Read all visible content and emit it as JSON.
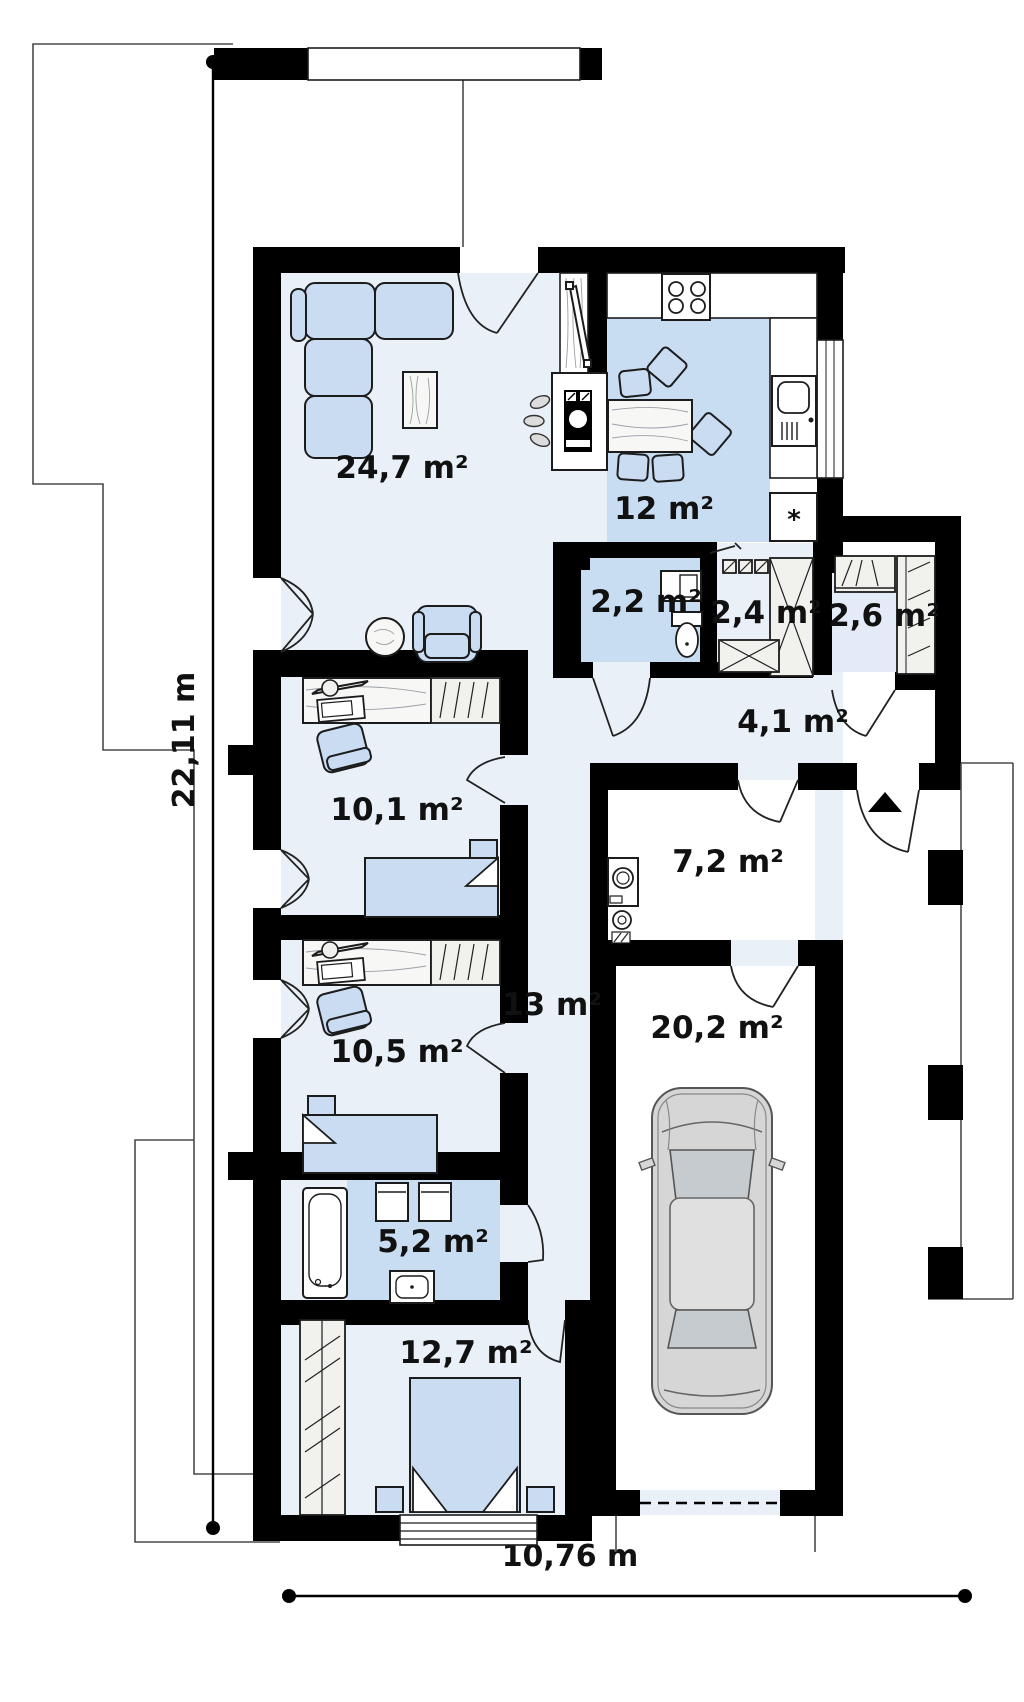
{
  "plan": {
    "type": "single-storey house floor plan with garage",
    "dimensions": {
      "height_label": "22,11 m",
      "width_label": "10,76 m"
    },
    "kitchen_symbols": {
      "fridge_symbol": "*"
    },
    "colors": {
      "wall": "#000000",
      "floor_light": "#eaf0f8",
      "floor_blue": "#c9ddf2",
      "furniture_blue": "#c9dcf2",
      "closet_fill": "#f1f1ee",
      "car_body": "#d6d6d6",
      "label_text": "#111111"
    }
  },
  "rooms": [
    {
      "id": "living-room",
      "area_label": "24,7 m²",
      "x": 402,
      "y": 478
    },
    {
      "id": "kitchen",
      "area_label": "12 m²",
      "x": 664,
      "y": 519
    },
    {
      "id": "wc",
      "area_label": "2,2 m²",
      "x": 646,
      "y": 612
    },
    {
      "id": "storage",
      "area_label": "2,4 m²",
      "x": 766,
      "y": 623
    },
    {
      "id": "wardrobe",
      "area_label": "2,6 m²",
      "x": 884,
      "y": 626
    },
    {
      "id": "hall",
      "area_label": "4,1 m²",
      "x": 793,
      "y": 732
    },
    {
      "id": "bedroom-1",
      "area_label": "10,1 m²",
      "x": 397,
      "y": 820
    },
    {
      "id": "utility",
      "area_label": "7,2 m²",
      "x": 728,
      "y": 872
    },
    {
      "id": "corridor",
      "area_label": "13 m²",
      "x": 552,
      "y": 1015
    },
    {
      "id": "garage",
      "area_label": "20,2 m²",
      "x": 717,
      "y": 1038
    },
    {
      "id": "bedroom-2",
      "area_label": "10,5 m²",
      "x": 397,
      "y": 1062
    },
    {
      "id": "bathroom",
      "area_label": "5,2 m²",
      "x": 433,
      "y": 1252
    },
    {
      "id": "bedroom-3",
      "area_label": "12,7 m²",
      "x": 466,
      "y": 1363
    }
  ]
}
